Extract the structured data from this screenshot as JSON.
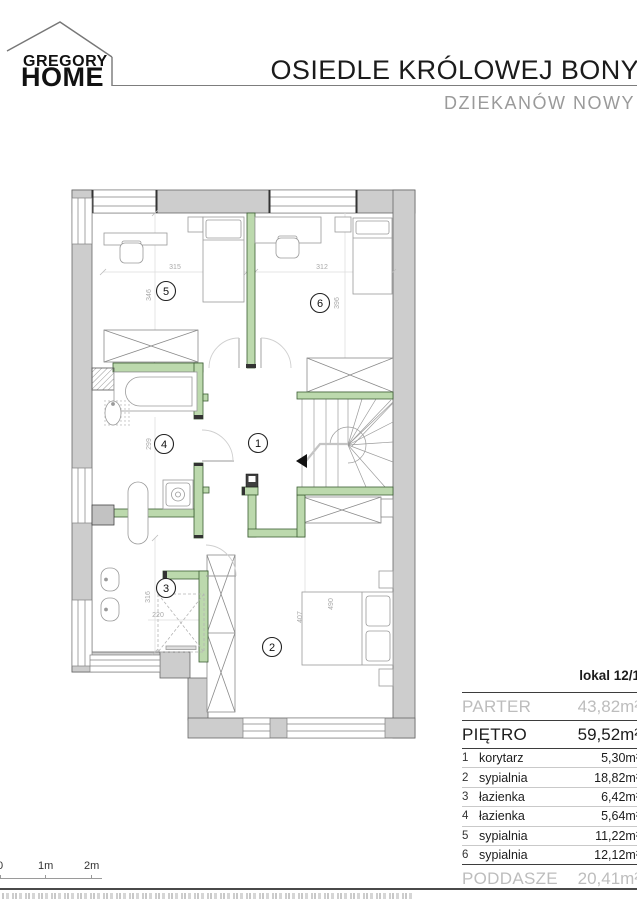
{
  "header": {
    "brand_top": "GREGORY",
    "brand_bottom": "HOME",
    "title": "OSIEDLE KRÓLOWEJ BONY",
    "subtitle": "DZIEKANÓW NOWY"
  },
  "plan": {
    "room_numbers": [
      "1",
      "2",
      "3",
      "4",
      "5",
      "6"
    ],
    "dims": {
      "room5_width": "315",
      "room5_depth": "346",
      "room6_width": "312",
      "room6_depth": "396",
      "room4_depth": "299",
      "room3_depth": "316",
      "room3_width": "220",
      "room2_width": "407",
      "room2_bed": "490"
    },
    "colors": {
      "exterior_wall": "#cdcdcd",
      "partition_green": "#bcd9ad",
      "dimension_gray": "#a9a9a9"
    }
  },
  "scalebar": {
    "t0": "0",
    "t1": "1m",
    "t2": "2m"
  },
  "table": {
    "unit": "lokal 12/1",
    "parter": {
      "label": "PARTER",
      "value": "43,82m²"
    },
    "pietro": {
      "label": "PIĘTRO",
      "value": "59,52m²"
    },
    "rows": [
      {
        "no": "1",
        "name": "korytarz",
        "area": "5,30m²"
      },
      {
        "no": "2",
        "name": "sypialnia",
        "area": "18,82m²"
      },
      {
        "no": "3",
        "name": "łazienka",
        "area": "6,42m²"
      },
      {
        "no": "4",
        "name": "łazienka",
        "area": "5,64m²"
      },
      {
        "no": "5",
        "name": "sypialnia",
        "area": "11,22m²"
      },
      {
        "no": "6",
        "name": "sypialnia",
        "area": "12,12m²"
      }
    ],
    "poddasze": {
      "label": "PODDASZE",
      "value": "20,41m²"
    }
  }
}
